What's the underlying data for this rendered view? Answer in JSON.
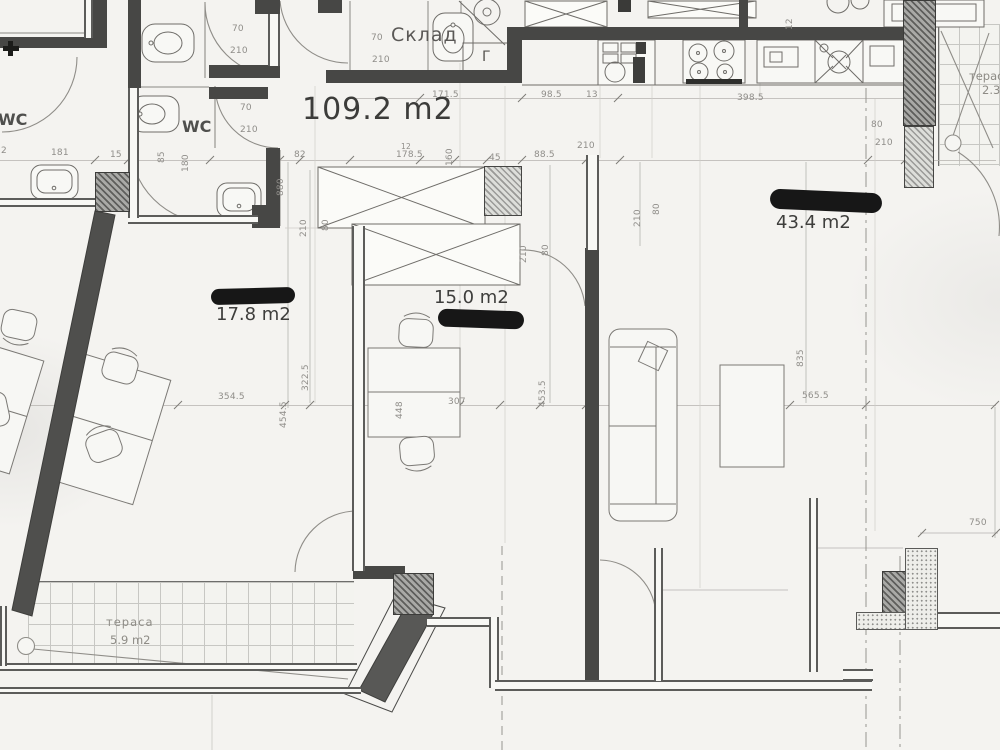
{
  "colors": {
    "paper": "#f4f3f0",
    "ink": "#474745",
    "dim_text": "#8f8d89",
    "redaction": "#171717"
  },
  "areas": {
    "main": "109.2 m2",
    "office_left": "17.8 m2",
    "cabinet": "15.0 m2",
    "cabinet_name": "кабинет",
    "living": "43.4 m2",
    "storage": "Склад",
    "wc_left": "WC",
    "wc_mid": "WC",
    "terrace_name": "тераса",
    "terrace_area": "5.9 m2",
    "terrace2_name": "тераса",
    "terrace2_area": "2.3",
    "appliance": "Г"
  },
  "dims": {
    "d1": "70",
    "d2": "210",
    "d3": "70",
    "d4": "210",
    "d5": "70",
    "d6": "210",
    "d7": "171.5",
    "d8": "98.5",
    "d9": "13",
    "d10": "398.5",
    "d11": "82",
    "d12": "12",
    "d13": "178.5",
    "d14": "160",
    "d15": "45",
    "d16": "88.5",
    "d17": "210",
    "d18": "80",
    "d19": "210",
    "d20": "2",
    "d21": "181",
    "d22": "15",
    "d23": "85",
    "d24": "180",
    "d25": "210",
    "d26": "80",
    "d27": "210",
    "d28": "80",
    "d29": "210",
    "d30": "80",
    "d31": "354.5",
    "d32": "454.5",
    "d33": "322.5",
    "d34": "307",
    "d35": "448",
    "d36": "453.5",
    "d37": "565.5",
    "d38": "835",
    "d39": "750",
    "d40": "880",
    "d41": "12"
  }
}
